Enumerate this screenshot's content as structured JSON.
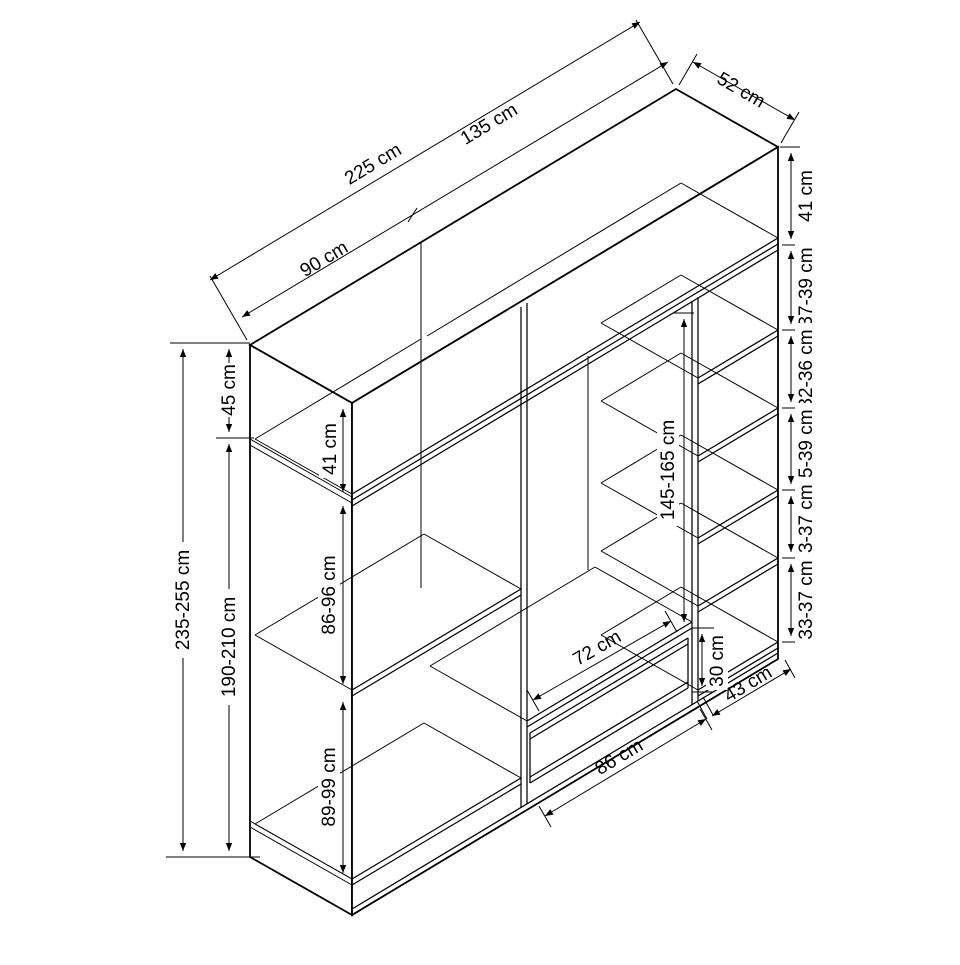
{
  "diagram": {
    "title": "wardrobe-dimension-drawing",
    "unit": "cm",
    "top": {
      "total_width": "225 cm",
      "left_width": "90 cm",
      "right_width": "135 cm",
      "depth": "52 cm"
    },
    "left": {
      "total_height": "235-255 cm",
      "top_cabinet_height": "45 cm",
      "lower_height": "190-210 cm"
    },
    "left_column": {
      "top_inner": "41 cm",
      "middle": "86-96 cm",
      "bottom": "89-99 cm"
    },
    "middle_column": {
      "hanging": "145-165 cm",
      "drawer_width": "72 cm",
      "drawer_height": "30 cm",
      "bottom_width": "86 cm"
    },
    "right_column": {
      "top_shelf": "41 cm",
      "gaps": [
        "37-39 cm",
        "32-36 cm",
        "35-39 cm",
        "33-37 cm",
        "33-37 cm"
      ],
      "bottom_width": "43 cm"
    }
  }
}
